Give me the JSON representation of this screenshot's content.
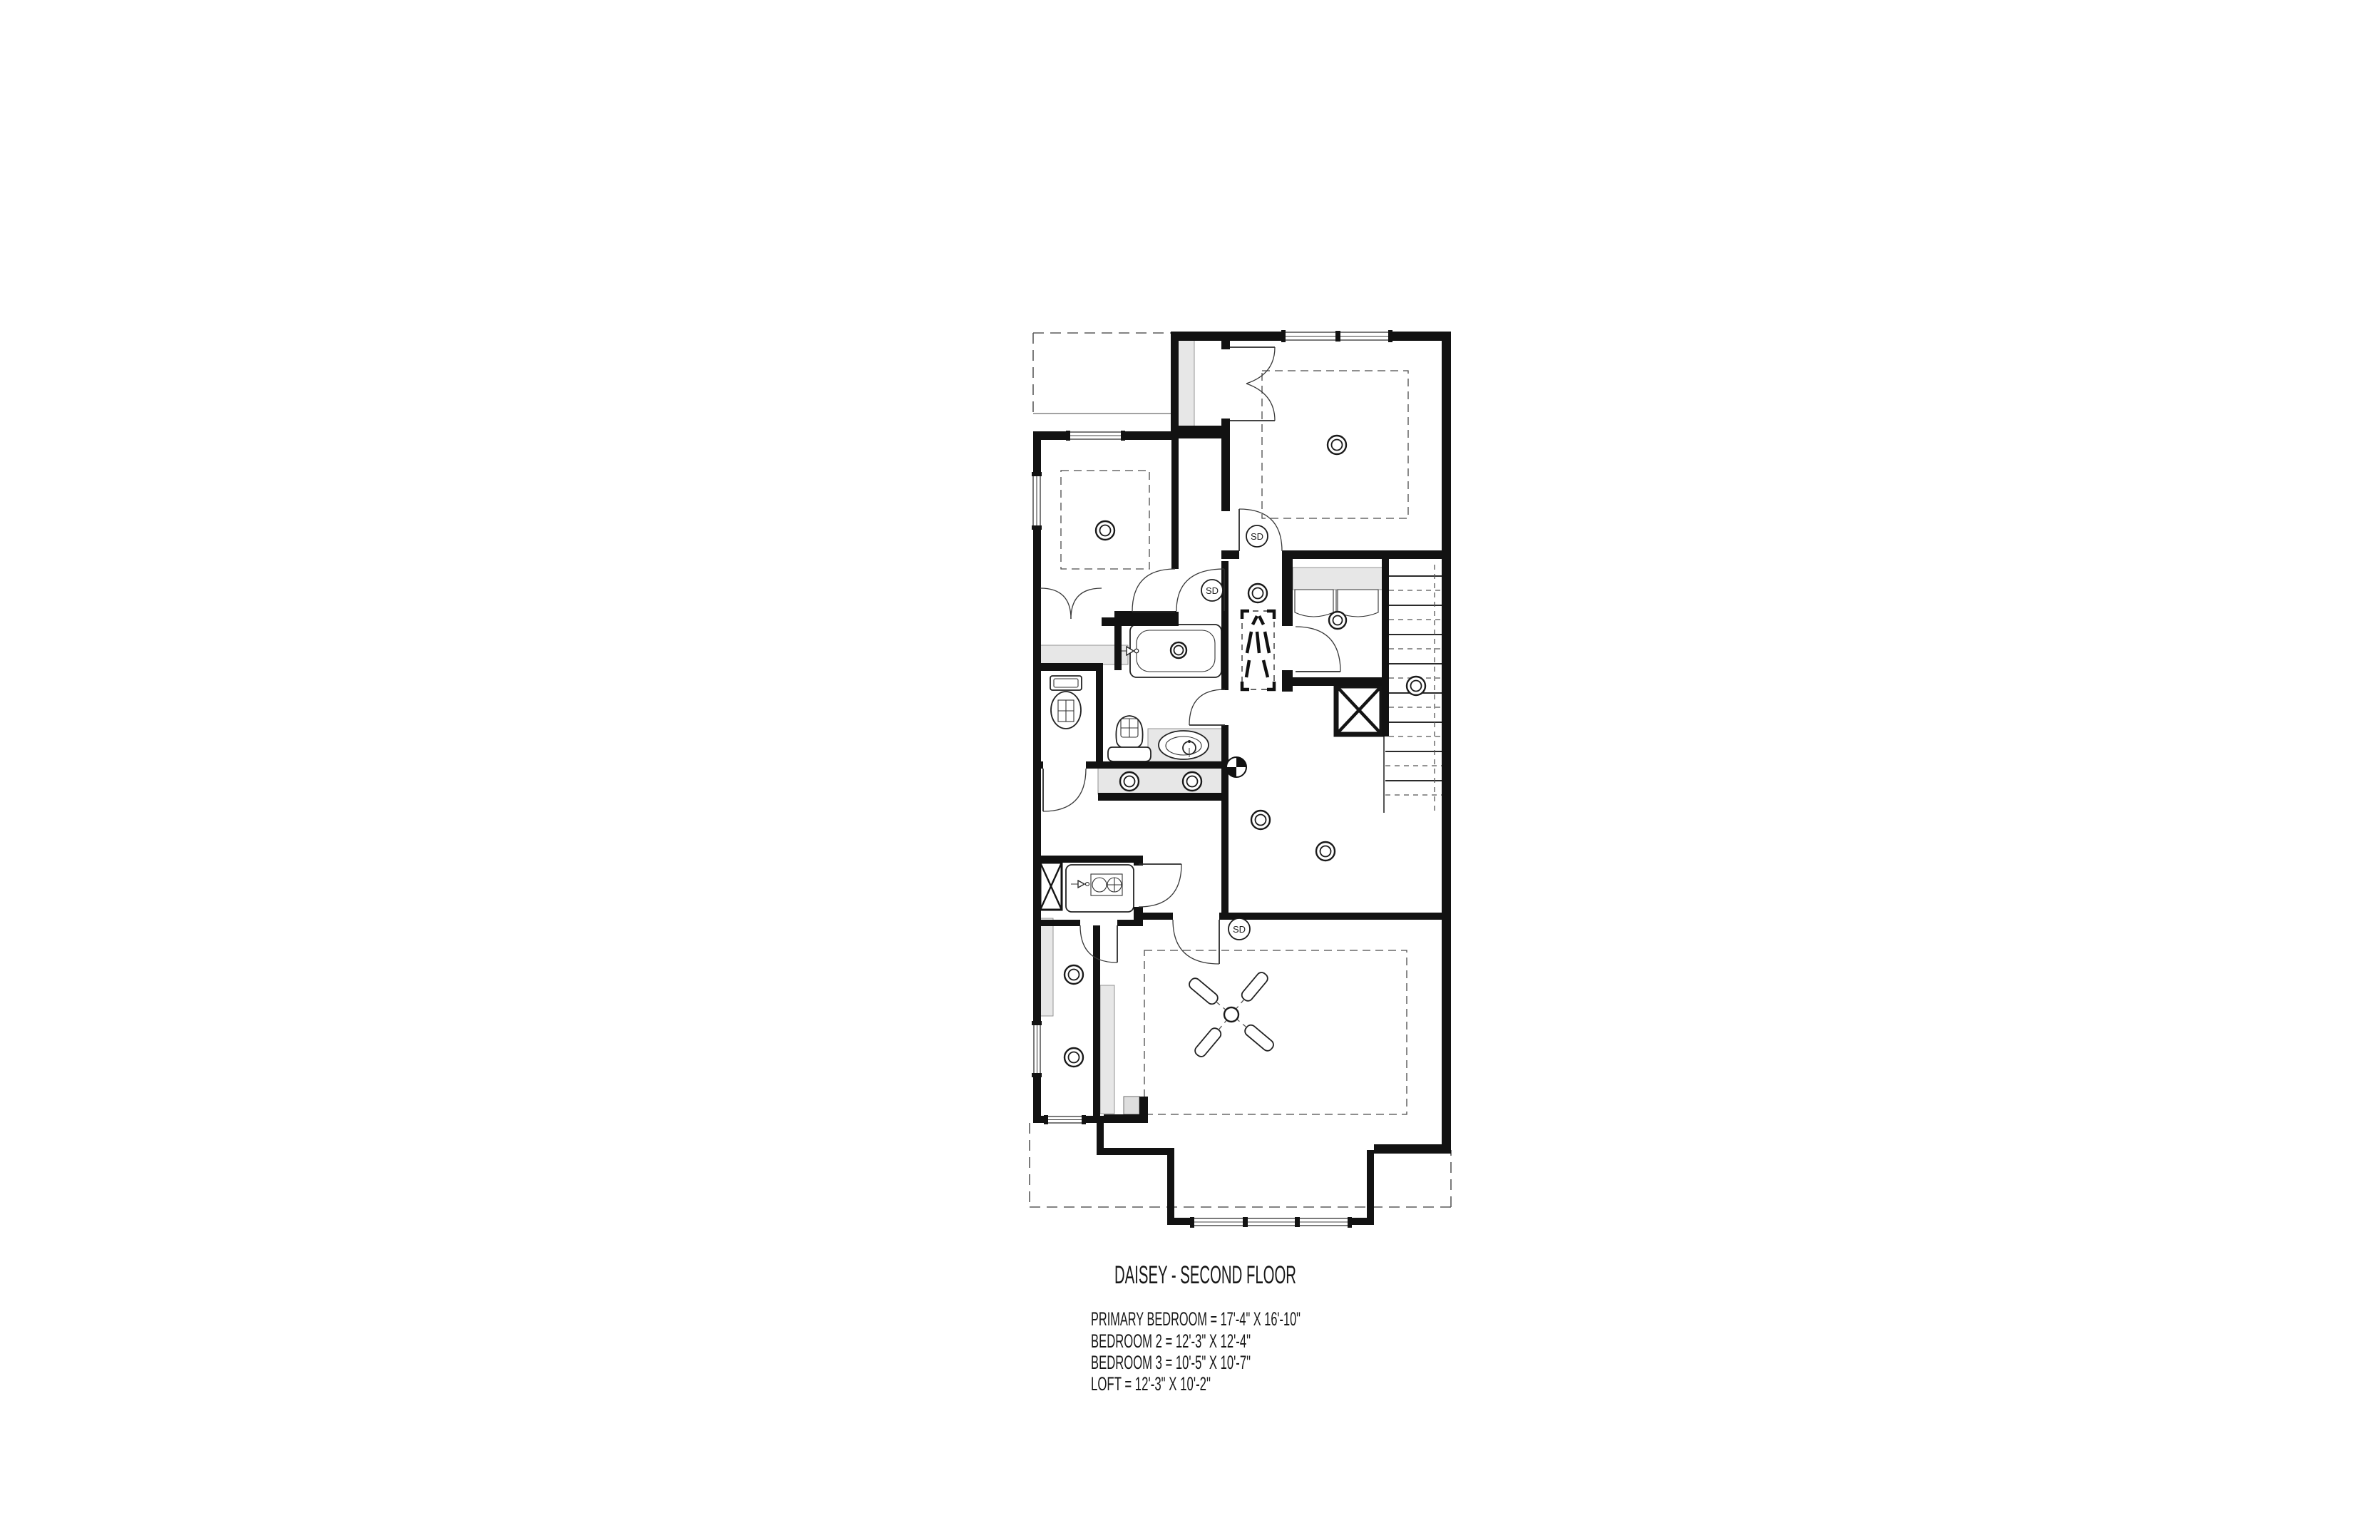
{
  "drawing": {
    "title": "DAISEY - SECOND FLOOR",
    "type": "architectural-floor-plan",
    "floor": "Second Floor",
    "plan_name": "Daisey",
    "legend": {
      "rooms": [
        {
          "name": "PRIMARY BEDROOM",
          "size": "17'-4\" X 16'-10\"",
          "text": "PRIMARY BEDROOM = 17'-4\" X 16'-10\""
        },
        {
          "name": "BEDROOM 2",
          "size": "12'-3\" X 12'-4\"",
          "text": "BEDROOM 2 = 12'-3\" X 12'-4\""
        },
        {
          "name": "BEDROOM 3",
          "size": "10'-5\" X 10'-7\"",
          "text": "BEDROOM 3 = 10'-5\" X 10'-7\""
        },
        {
          "name": "LOFT",
          "size": "12'-3\" X 10'-2\"",
          "text": "LOFT = 12'-3\" X 10'-2\""
        }
      ]
    },
    "symbols": {
      "smoke_detector": "SD",
      "icon_names": [
        "smoke-detector-icon",
        "ceiling-light-icon",
        "ceiling-fan-icon",
        "bathtub-icon",
        "toilet-icon",
        "sink-icon",
        "laundry-sink-icon",
        "stairs-icon",
        "attic-access-icon",
        "centroid-marker-icon",
        "closet-rod-icon",
        "shelf-icon",
        "linen-closet-x-icon",
        "window-icon",
        "door-swing-icon"
      ]
    },
    "colors": {
      "background": "#ffffff",
      "walls": "#121212",
      "fixture_fill": "#e7e7e7",
      "dashed_lines": "#5a5a5a"
    }
  }
}
